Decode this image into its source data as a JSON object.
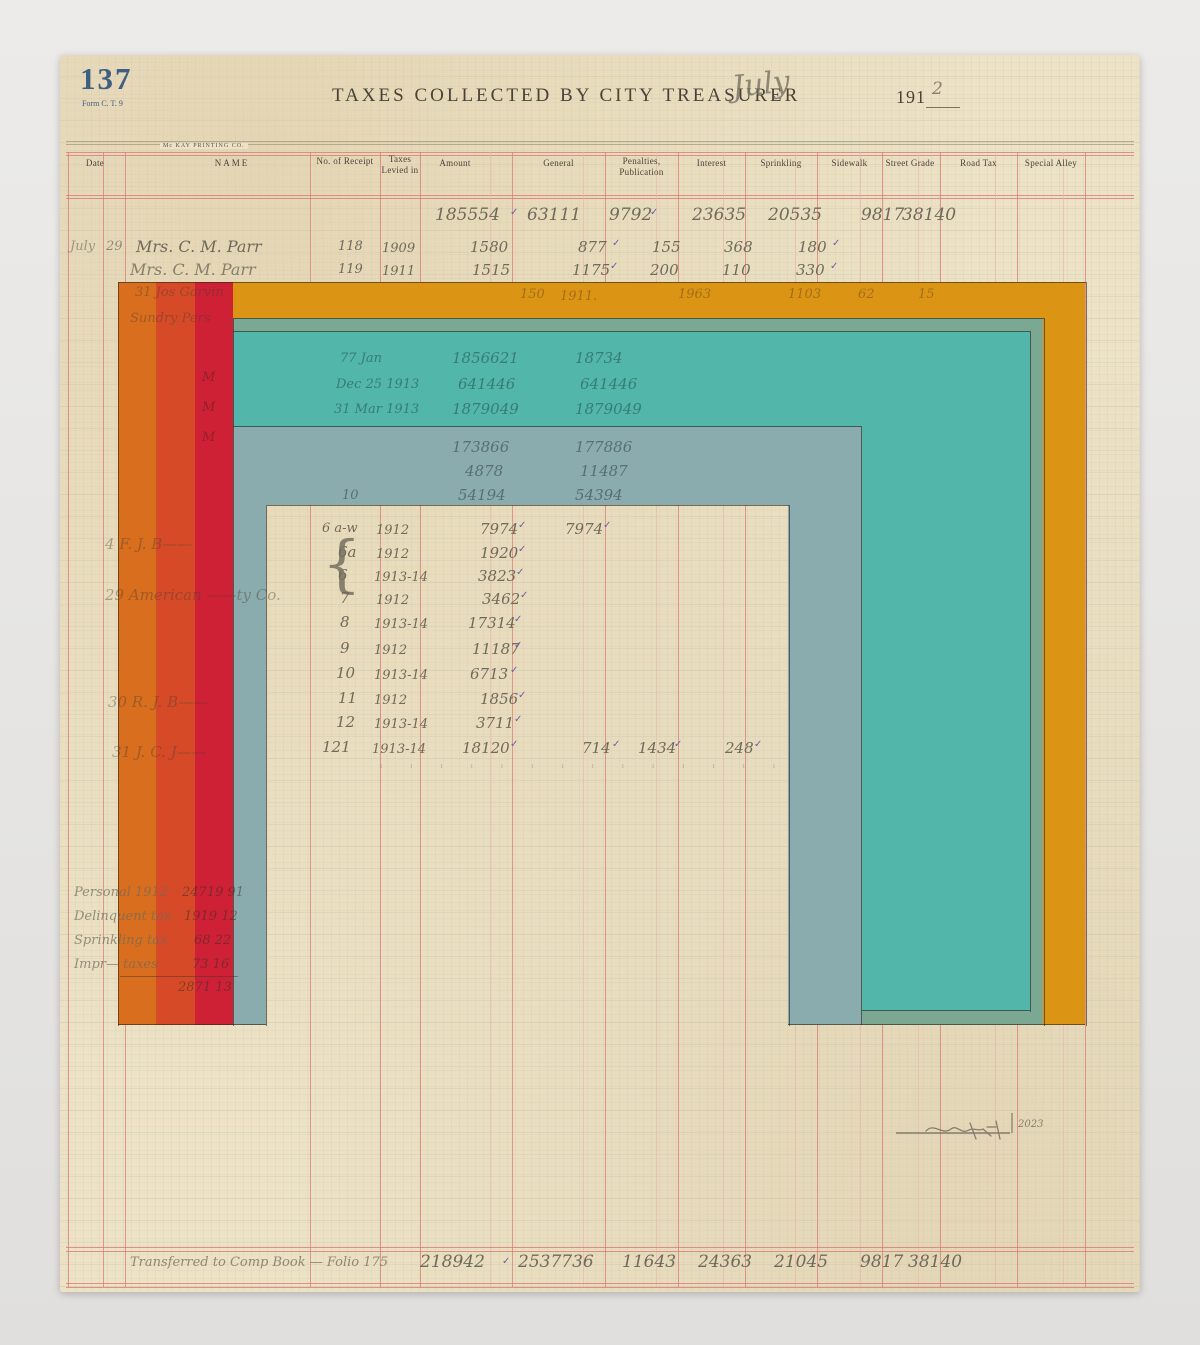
{
  "page": {
    "number": "137",
    "form": "Form C. T. 9",
    "title": "TAXES COLLECTED BY CITY TREASURER",
    "month_handwritten": "July",
    "year_printed": "191",
    "year_handwritten": "2",
    "printer": "Mc KAY PRINTING CO."
  },
  "header": {
    "columns": [
      "Date",
      "NAME",
      "No. of Receipt",
      "Taxes Levied in",
      "Amount",
      "General",
      "Penalties, Publication",
      "Interest",
      "Sprinkling",
      "Sidewalk",
      "Street Grade",
      "Road Tax",
      "Special Alley"
    ]
  },
  "totals_top": {
    "values": [
      "185554",
      "63111",
      "9792",
      "23635",
      "20535",
      "9817",
      "38140"
    ]
  },
  "entries": [
    {
      "date": "July",
      "day": "29",
      "name": "Mrs. C. M. Parr",
      "receipt": "118",
      "levied": "1909",
      "amount": "1580",
      "general": "877",
      "penalties": "155",
      "interest": "368",
      "sprinkling": "180"
    },
    {
      "name": "Mrs. C. M. Parr",
      "receipt": "119",
      "levied": "1911",
      "amount": "1515",
      "general": "1175",
      "penalties": "200",
      "interest": "110",
      "sprinkling": "330"
    }
  ],
  "faint": {
    "amber_row": {
      "receipt": "150",
      "levied": "1911.",
      "amount": "1963",
      "general": "1103",
      "penalties": "62",
      "interest": "15"
    },
    "names": [
      "31  Jos Garvin",
      "Sundry Pers"
    ],
    "teal_rows": [
      {
        "date": "77 Jan",
        "amount": "1856621",
        "general": "18734"
      },
      {
        "date": "Dec 25 1913",
        "amount": "641446",
        "general": "641446"
      },
      {
        "date": "31 Mar 1913",
        "amount": "1879049",
        "general": "1879049"
      }
    ],
    "slate_rows": [
      {
        "date": "",
        "amount": "173866",
        "general": "177886"
      },
      {
        "date": "",
        "amount": "4878",
        "general": "11487"
      },
      {
        "date": "10",
        "amount": "54194",
        "general": "54394"
      }
    ],
    "stripe_marks": [
      "M",
      "M",
      "M"
    ],
    "window_names": [
      "4  F. J. B——",
      "29  American ——ty Co.",
      "30  R. J. B——",
      "31  J. C. J——"
    ]
  },
  "receipt_rows": [
    {
      "receipt": "6 a-w",
      "levied": "1912",
      "amount": "7974",
      "general": "7974"
    },
    {
      "receipt": "6a",
      "levied": "1912",
      "amount": "1920"
    },
    {
      "receipt": "6",
      "levied": "1913-14",
      "amount": "3823"
    },
    {
      "receipt": "7",
      "levied": "1912",
      "amount": "3462"
    },
    {
      "receipt": "8",
      "levied": "1913-14",
      "amount": "17314"
    },
    {
      "receipt": "9",
      "levied": "1912",
      "amount": "11187"
    },
    {
      "receipt": "10",
      "levied": "1913-14",
      "amount": "6713"
    },
    {
      "receipt": "11",
      "levied": "1912",
      "amount": "1856"
    },
    {
      "receipt": "12",
      "levied": "1913-14",
      "amount": "3711"
    },
    {
      "receipt": "121",
      "levied": "1913-14",
      "amount": "18120",
      "general": "714",
      "penalties": "1434",
      "interest": "248"
    }
  ],
  "brace": "{",
  "tick_row": "ı ı ı ı ı ı ı ı ı ı ı ı ı ı ı ı ı ı ı",
  "summary_left": {
    "rows": [
      {
        "label": "Personal 1912",
        "value": "24719 91"
      },
      {
        "label": "Delinquent tax",
        "value": "1919 12"
      },
      {
        "label": "Sprinkling tax",
        "value": "68 22"
      },
      {
        "label": "Impr— taxes",
        "value": "73 16"
      }
    ],
    "total": "2871 13"
  },
  "footer": {
    "note": "Transferred to Comp Book — Folio 175",
    "values": [
      "218942",
      "2537736",
      "11643",
      "24363",
      "21045",
      "9817",
      "38140"
    ]
  },
  "signature": {
    "year": "2023"
  },
  "marks": {
    "check": "✓"
  },
  "palette": {
    "photo_bg": "#E6E5E3",
    "paper": "#EDE2C6",
    "red_line": "#DC7B76",
    "red_line_light": "#EBB4AD",
    "print_ink": "#4A4238",
    "blue_ink": "#3E5F82",
    "pencil": "#6F6A5B",
    "purple": "#6A5EA8",
    "orange": "#D96E1E",
    "red_orange": "#D74A28",
    "red": "#CF2135",
    "amber": "#DC9414",
    "teal": "#53B6AB",
    "muted_teal": "#7AA893",
    "slate": "#8BACAE",
    "outline": "#3A3428"
  }
}
